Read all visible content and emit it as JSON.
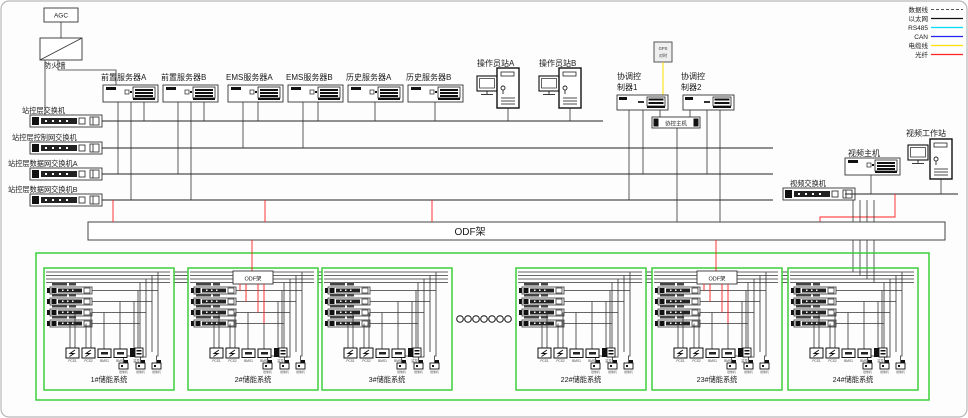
{
  "legend": {
    "items": [
      {
        "label": "数据线",
        "color": "#555555"
      },
      {
        "label": "以太网",
        "color": "#111111"
      },
      {
        "label": "RS485",
        "color": "#00dcff"
      },
      {
        "label": "CAN",
        "color": "#2222ee"
      },
      {
        "label": "电缆线",
        "color": "#ffe000"
      },
      {
        "label": "光纤",
        "color": "#ff2222"
      }
    ]
  },
  "top": {
    "agc": "AGC",
    "firewall": "防火墙"
  },
  "switches": [
    {
      "label": "站控层交换机"
    },
    {
      "label": "站控层控制网交换机"
    },
    {
      "label": "站控层数据网交换机A"
    },
    {
      "label": "站控层数据网交换机B"
    }
  ],
  "servers": [
    {
      "label": "前置服务器A"
    },
    {
      "label": "前置服务器B"
    },
    {
      "label": "EMS服务器A"
    },
    {
      "label": "EMS服务器B"
    },
    {
      "label": "历史服务器A"
    },
    {
      "label": "历史服务器B"
    }
  ],
  "operators": [
    {
      "label": "操作员站A"
    },
    {
      "label": "操作员站B"
    }
  ],
  "controllers": {
    "c1_line1": "协调控",
    "c1_line2": "制器1",
    "c2_line1": "协调控",
    "c2_line2": "制器2",
    "host": "协控主机",
    "timesync_line1": "GPS",
    "timesync_line2": "对时"
  },
  "video": {
    "switch": "视频交换机",
    "host": "视频主机",
    "workstation": "视频工作站"
  },
  "odf": {
    "main": "ODF架",
    "unit": "ODF架"
  },
  "storage": {
    "units": [
      {
        "label": "1#储能系统",
        "has_odf": false
      },
      {
        "label": "2#储能系统",
        "has_odf": true
      },
      {
        "label": "3#储能系统",
        "has_odf": false
      },
      {
        "label": "22#储能系统",
        "has_odf": false
      },
      {
        "label": "23#储能系统",
        "has_odf": true
      },
      {
        "label": "24#储能系统",
        "has_odf": false
      }
    ],
    "device_labels": [
      "PCS1",
      "PCS2",
      "BMS1",
      "BMS2",
      "监控"
    ],
    "camera_label": "摄像机"
  }
}
